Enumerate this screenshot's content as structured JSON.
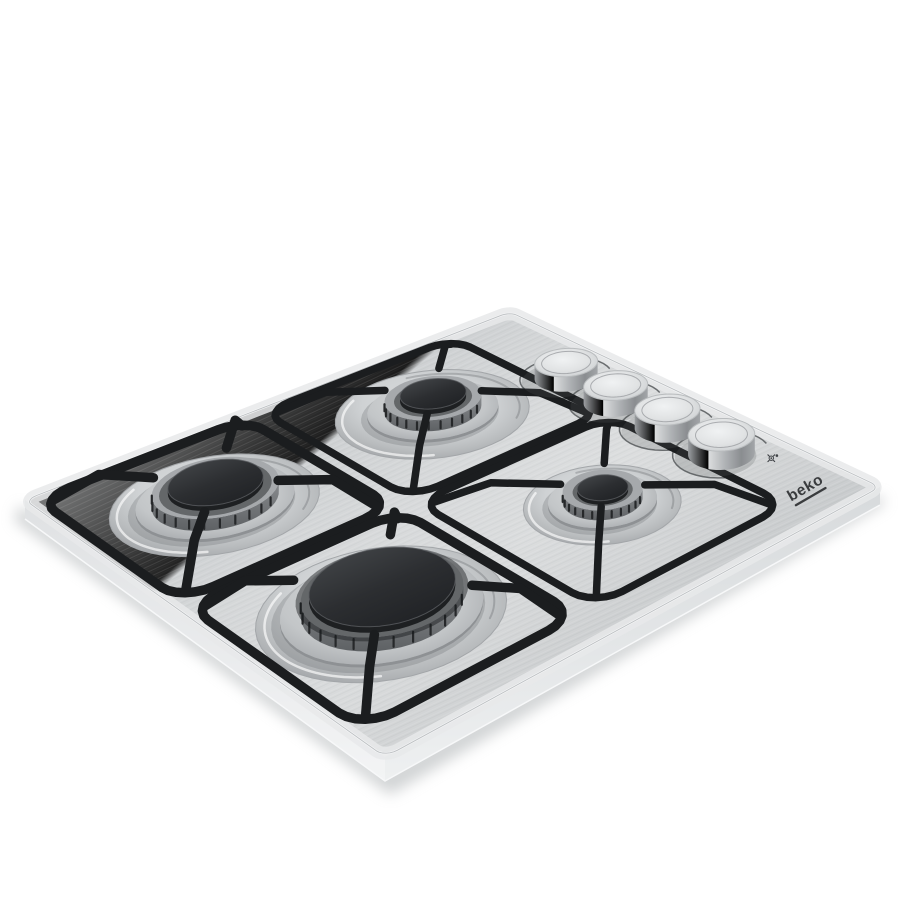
{
  "product": {
    "brand": "beko",
    "category": "built-in 4-burner stainless steel gas hob",
    "burners": [
      {
        "id": "back-left",
        "size": "semi-rapid",
        "u": 0.235,
        "v": 0.3575,
        "recess": 0.17,
        "skirt": 0.115,
        "body": 0.085,
        "cap": 0.058,
        "bodyLift": 4,
        "bodyH": 11,
        "capLift": 19,
        "capH": 5
      },
      {
        "id": "back-right",
        "size": "auxiliary",
        "u": 0.7,
        "v": 0.3575,
        "recess": 0.13,
        "skirt": 0.09,
        "body": 0.066,
        "cap": 0.042,
        "bodyLift": 4,
        "bodyH": 10,
        "capLift": 16,
        "capH": 4
      },
      {
        "id": "front-left",
        "size": "rapid",
        "u": 0.235,
        "v": 0.7925,
        "recess": 0.165,
        "skirt": 0.125,
        "body": 0.1,
        "cap": 0.075,
        "bodyLift": 4,
        "bodyH": 12,
        "capLift": 21,
        "capH": 5
      },
      {
        "id": "front-right",
        "size": "wok",
        "u": 0.7,
        "v": 0.7925,
        "recess": 0.185,
        "skirt": 0.15,
        "body": 0.12,
        "cap": 0.108,
        "bodyLift": 5,
        "bodyH": 14,
        "capLift": 25,
        "capH": 6
      }
    ],
    "pan_supports": [
      {
        "id": "back-left",
        "u1": 0.015,
        "v1": 0.15,
        "u2": 0.455,
        "v2": 0.565,
        "stroke": 7.5,
        "peak": 20,
        "burner": 0
      },
      {
        "id": "back-right",
        "u1": 0.475,
        "v1": 0.15,
        "u2": 0.925,
        "v2": 0.565,
        "stroke": 7.5,
        "peak": 20,
        "burner": 1
      },
      {
        "id": "front-left",
        "u1": 0.015,
        "v1": 0.6,
        "u2": 0.455,
        "v2": 0.985,
        "stroke": 9.5,
        "peak": 26,
        "burner": 2
      },
      {
        "id": "front-right",
        "u1": 0.475,
        "v1": 0.6,
        "u2": 0.925,
        "v2": 0.985,
        "stroke": 9.5,
        "peak": 26,
        "burner": 3
      }
    ],
    "knobs": [
      {
        "id": "knob-1",
        "u": 0.3,
        "icon": "burner-position-icon"
      },
      {
        "id": "knob-2",
        "u": 0.44,
        "icon": "burner-position-icon"
      },
      {
        "id": "knob-3",
        "u": 0.58,
        "icon": "burner-position-icon"
      },
      {
        "id": "knob-4",
        "u": 0.72,
        "icon": "burner-position-icon"
      }
    ],
    "knob_v": 0.105,
    "knob_r": 0.058,
    "knob_arc_r": 0.085
  },
  "palette": {
    "background": "#ffffff",
    "steel_light": "#e9ebec",
    "steel_mid": "#cfd2d4",
    "steel_dark": "#b6b9bc",
    "grate_black": "#1b1d1f",
    "cap_charcoal": "#2c2e31",
    "burner_metal": "#9ca0a2",
    "print_gray": "#55585a",
    "logo_gray": "#3a3c3e"
  },
  "view": {
    "quad": {
      "back": [
        510,
        312
      ],
      "right": [
        880,
        487
      ],
      "left": [
        25,
        500
      ],
      "front": [
        385,
        757
      ]
    },
    "edge_thickness": 22
  }
}
